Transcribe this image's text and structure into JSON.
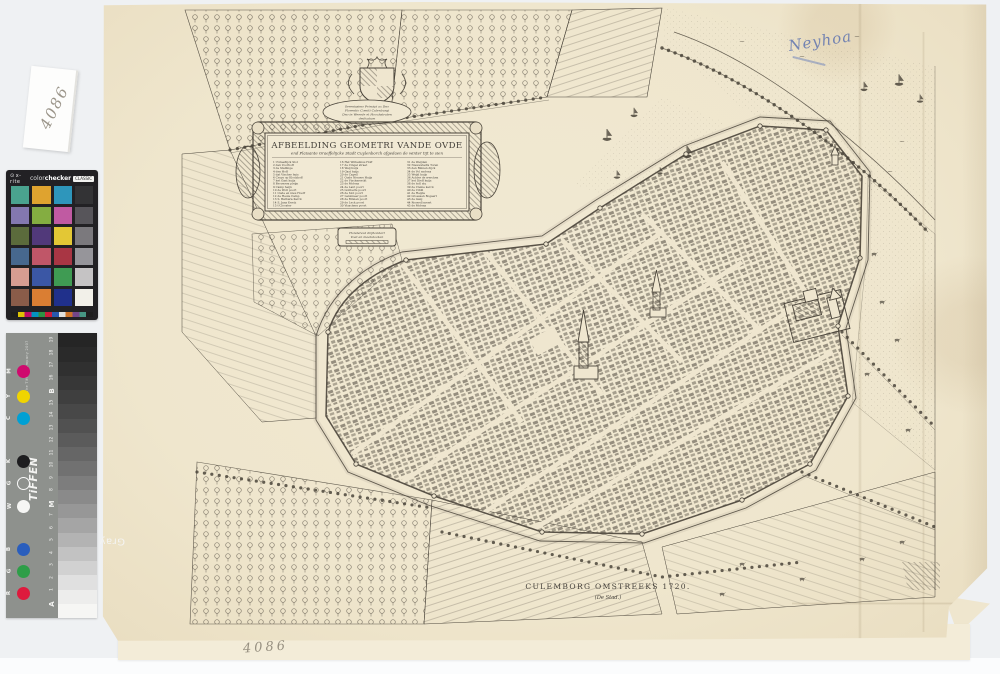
{
  "photo": {
    "slip_number": "4086",
    "pencil_number": "4086",
    "handwritten_note": "Neyhoa"
  },
  "colorchecker": {
    "brand": "x-rite",
    "product_light": "color",
    "product_bold": "checker",
    "badge": "CLASSIC",
    "swatches": [
      "#4aa38f",
      "#dfa32f",
      "#2e96bb",
      "#333335",
      "#8378af",
      "#84ad41",
      "#c05aa2",
      "#57555a",
      "#5b6b3c",
      "#51397a",
      "#e3c735",
      "#7b797d",
      "#47688e",
      "#c05668",
      "#a93644",
      "#96959a",
      "#d79d91",
      "#3b57a5",
      "#3f9b53",
      "#c5c3c4",
      "#8a5c49",
      "#da7e33",
      "#20308b",
      "#f2f0e9"
    ],
    "ruler_colors": [
      "#1d1d1d",
      "#f2d500",
      "#cf0a6e",
      "#00a0d4",
      "#2e9e48",
      "#de1a3d",
      "#2a5ebd",
      "#f6f6f4",
      "#e07c28",
      "#7d4a94",
      "#4aa38f",
      "#1d1d1d"
    ]
  },
  "tiffen": {
    "brand": "TiFFEN",
    "product": "Gray Scale",
    "copyright": "© The Tiffen Company 2007",
    "scale_numbers": [
      "19",
      "18",
      "17",
      "16",
      "B",
      "15",
      "14",
      "13",
      "12",
      "11",
      "10",
      "9",
      "8",
      "M",
      "7",
      "6",
      "5",
      "4",
      "3",
      "2",
      "1",
      "A"
    ],
    "dots": [
      {
        "label": "M",
        "color": "#cf0a6e",
        "y": 32
      },
      {
        "label": "Y",
        "color": "#f0d400",
        "y": 57
      },
      {
        "label": "C",
        "color": "#00a0d4",
        "y": 79
      },
      {
        "label": "K",
        "color": "#1d1d1f",
        "y": 122
      },
      {
        "label": "G",
        "color": "",
        "outline": true,
        "y": 144
      },
      {
        "label": "W",
        "color": "#f6f6f4",
        "y": 167
      },
      {
        "label": "B",
        "color": "#2a5ebd",
        "y": 210
      },
      {
        "label": "G",
        "color": "#2e9e48",
        "y": 232
      },
      {
        "label": "R",
        "color": "#de1a3d",
        "y": 254
      }
    ],
    "gray_steps": [
      "#252525",
      "#2a2a2a",
      "#303030",
      "#373737",
      "#3f3f3f",
      "#484848",
      "#515151",
      "#5b5b5b",
      "#666666",
      "#717171",
      "#7d7d7d",
      "#8a8a8a",
      "#979797",
      "#a5a5a5",
      "#b3b3b3",
      "#c2c2c2",
      "#d1d1d1",
      "#e0e0e0",
      "#ededec",
      "#f6f6f4"
    ]
  },
  "map": {
    "cartouche": {
      "imprint_lines": [
        "Serenissimo Principi ac Dno",
        "Florentio Comiti Culenburgi",
        "Dno in Weerde et Hoochstraten",
        "dedicatum"
      ],
      "title": "AFBEELDING GEOMETRI VANDE OVDE",
      "subtitle": "end Plaisante Graeffelijcke Stadt Cuylenborch afgedaen de winter tijt te sien",
      "legend_col1": [
        "1  t'Graeflijck Slot",
        "2  den Voorhoff",
        "3  de Stallinge",
        "4  den Hoff",
        "5  dat Vischer huis",
        "6  Cruys op Klockhoff",
        "7  het Gast huijs",
        "8  Brouwers pleijn",
        "9  Camp heijn",
        "10 de Woll poort",
        "11 Oude en nieu Hooff",
        "12 de Heule Camp",
        "13 S. Barbara Kerck",
        "14 S. Jans Kerck",
        "15 t'Clooster"
      ],
      "legend_col2": [
        "16 Het Wilhelmus Hoff",
        "17 de Cingel straet",
        "18 Weij huijs",
        "19 Gast huijs",
        "20 de Capell",
        "21 Oude Nieuwe Huijs",
        "22 de Vischmerckt",
        "23 de Molens",
        "24 de Lant poort",
        "25 Goilberts poort",
        "26 de Slot poort",
        "27 Lanxmeer poort",
        "28 de Binnen poort",
        "29 de Leck poort",
        "30 Visschers poort"
      ],
      "legend_col3": [
        "31 de Weijden",
        "32 Nieuwstadts Toren",
        "33 den Binnen dijck",
        "34 de Vol molens",
        "35 Weijd huijs",
        "36 Achter de wercken",
        "37 het Dieff huijs",
        "38 de holl stu",
        "39 de Cleine kerck",
        "40 de Cibill",
        "41 de Heijde",
        "42 Groessen Bogaert",
        "43 de Galg",
        "44 Roswell merrt",
        "45 de Molens"
      ]
    },
    "scale_cartouche": {
      "line1": "Hondereut drijhondert",
      "line2": "Voet en maetstocken"
    },
    "caption_line1": "CULEMBORG OMSTREEKS 1720.",
    "caption_line2": "(De Stad.)"
  }
}
